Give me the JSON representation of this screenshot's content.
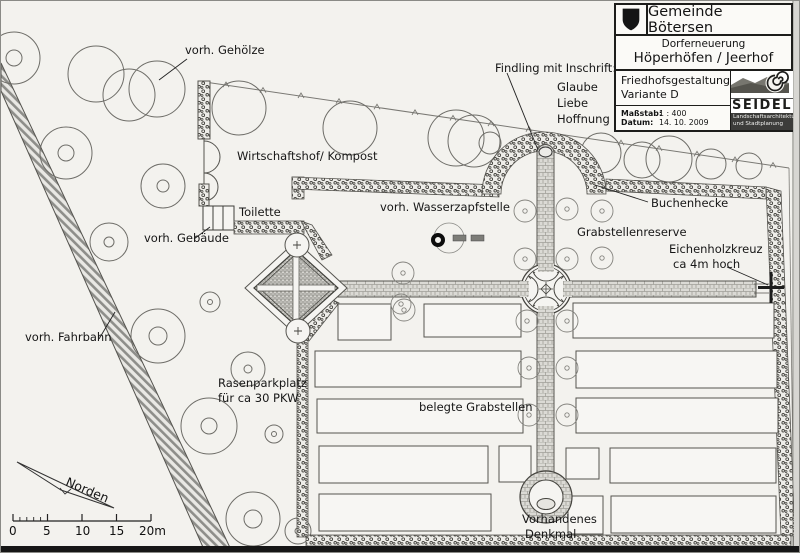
{
  "title_block": {
    "municipality": "Gemeinde Bötersen",
    "project_line1": "Dorferneuerung",
    "project_line2": "Höperhöfen / Jeerhof",
    "plan_title_line1": "Friedhofsgestaltung",
    "plan_title_line2": "Variante D",
    "scale_label": "Maßstab:",
    "scale_value": "1 : 400",
    "date_label": "Datum:",
    "date_value": "14. 10. 2009",
    "firm_name": "SEIDEL",
    "firm_subtitle_line1": "Landschaftsarchitektur",
    "firm_subtitle_line2": "und Stadtplanung"
  },
  "plan_labels": {
    "gehoelze": "vorh. Gehölze",
    "findling_caption": "Findling mit Inschrift:",
    "inschrift_line1": "Glaube",
    "inschrift_line2": "Liebe",
    "inschrift_line3": "Hoffnung",
    "wirtschaftshof": "Wirtschaftshof/ Kompost",
    "toilette": "Toilette",
    "gebaeude": "vorh. Gebäude",
    "wasserzapfstelle": "vorh. Wasserzapfstelle",
    "grabstellenreserve": "Grabstellenreserve",
    "buchenhecke": "Buchenhecke",
    "eichenholzkreuz_line1": "Eichenholzkreuz",
    "eichenholzkreuz_line2": "ca 4m hoch",
    "fahrbahn": "vorh. Fahrbahn",
    "rasenparkplatz_line1": "Rasenparkplatz",
    "rasenparkplatz_line2": "für ca 30 PKW",
    "belegte_grabstellen": "belegte Grabstellen",
    "denkmal_line1": "Vorhandenes",
    "denkmal_line2": "Denkmal"
  },
  "north_arrow": {
    "label": "Norden"
  },
  "scale_bar": {
    "ticks": [
      "0",
      "5",
      "10",
      "15",
      "20m"
    ]
  },
  "icons": {
    "crest": "coat-of-arms-shield-icon",
    "firm_logo": "spiral-snail-logo-icon",
    "north": "north-arrow-icon",
    "water_tap": "water-tap-icon",
    "oak_cross": "wooden-cross-icon"
  },
  "colors": {
    "paper": "#f3f2ee",
    "line": "#3f3f3a",
    "path_fill": "#dbdad5",
    "hedge_dot": "#45443f",
    "scan_strip": "#161616"
  }
}
